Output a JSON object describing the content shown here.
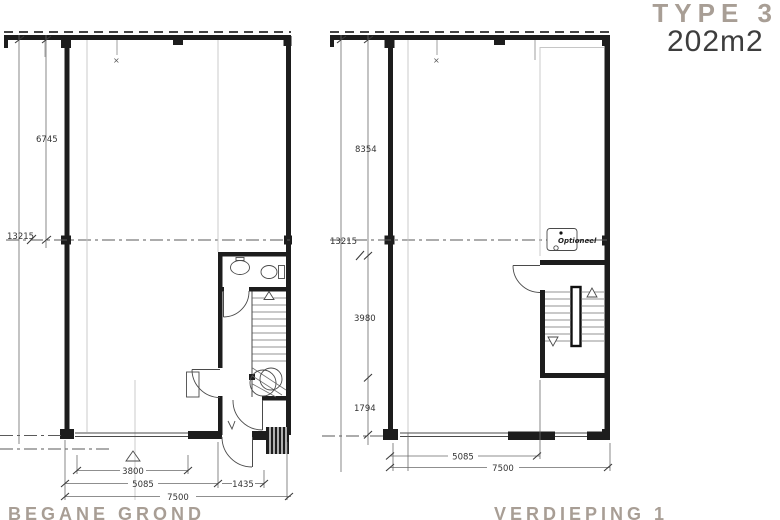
{
  "header": {
    "type_label": "TYPE 3",
    "area_label": "202m2"
  },
  "colors": {
    "wall": "#1d1d1d",
    "dim_line": "#6a6a6a",
    "dim_text": "#333333",
    "muted_title": "#a89e95",
    "area_text": "#3d3d3d"
  },
  "ground_floor": {
    "title": "BEGANE GROND",
    "marker": "×",
    "dims": {
      "total_height": "13215",
      "upper_height": "6745",
      "window_width": "3800",
      "room_width": "5085",
      "entry_width": "1435",
      "total_width": "7500"
    }
  },
  "first_floor": {
    "title": "VERDIEPING 1",
    "marker": "×",
    "optional_label": "Optioneel",
    "dims": {
      "total_height": "13215",
      "upper_height": "8354",
      "mid_height": "3980",
      "lower_height": "1794",
      "room_width": "5085",
      "total_width": "7500"
    }
  }
}
